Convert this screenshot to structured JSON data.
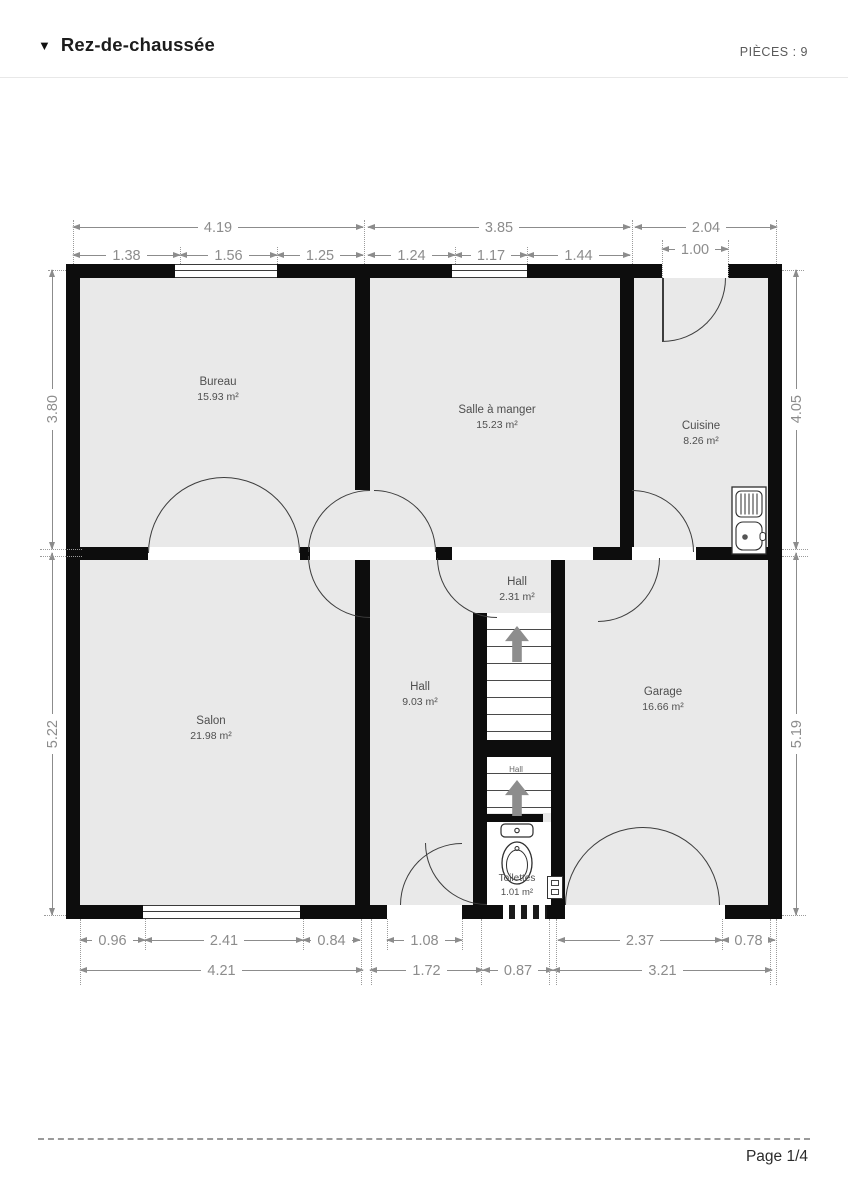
{
  "header": {
    "collapse_icon": "▼",
    "title": "Rez-de-chaussée",
    "pieces_label": "PIÈCES :",
    "pieces_count": "9"
  },
  "plan": {
    "rooms": [
      {
        "name": "Bureau",
        "area": "15.93 m²"
      },
      {
        "name": "Salle à manger",
        "area": "15.23 m²"
      },
      {
        "name": "Cuisine",
        "area": "8.26 m²"
      },
      {
        "name": "Salon",
        "area": "21.98 m²"
      },
      {
        "name": "Hall",
        "area": "9.03 m²"
      },
      {
        "name": "Hall",
        "area": "2.31 m²"
      },
      {
        "name": "Garage",
        "area": "16.66 m²"
      },
      {
        "name": "Toilettes",
        "area": "1.01 m²"
      },
      {
        "name": "Hall",
        "area": ""
      }
    ],
    "dims": {
      "top_overall": [
        "4.19",
        "3.85",
        "2.04"
      ],
      "top_detail": [
        "1.38",
        "1.56",
        "1.25",
        "1.24",
        "1.17",
        "1.44",
        "1.00"
      ],
      "left": [
        "3.80",
        "5.22"
      ],
      "right": [
        "4.05",
        "5.19"
      ],
      "bottom_detail": [
        "0.96",
        "2.41",
        "0.84",
        "1.08",
        "2.37",
        "0.78"
      ],
      "bottom_overall": [
        "4.21",
        "1.72",
        "0.87",
        "3.21"
      ]
    },
    "colors": {
      "wall": "#0d0d0d",
      "room_fill": "#e9e9e9",
      "dimension": "#8c8c8c",
      "label": "#4f4f4f"
    }
  },
  "footer": {
    "page": "Page 1/4"
  }
}
